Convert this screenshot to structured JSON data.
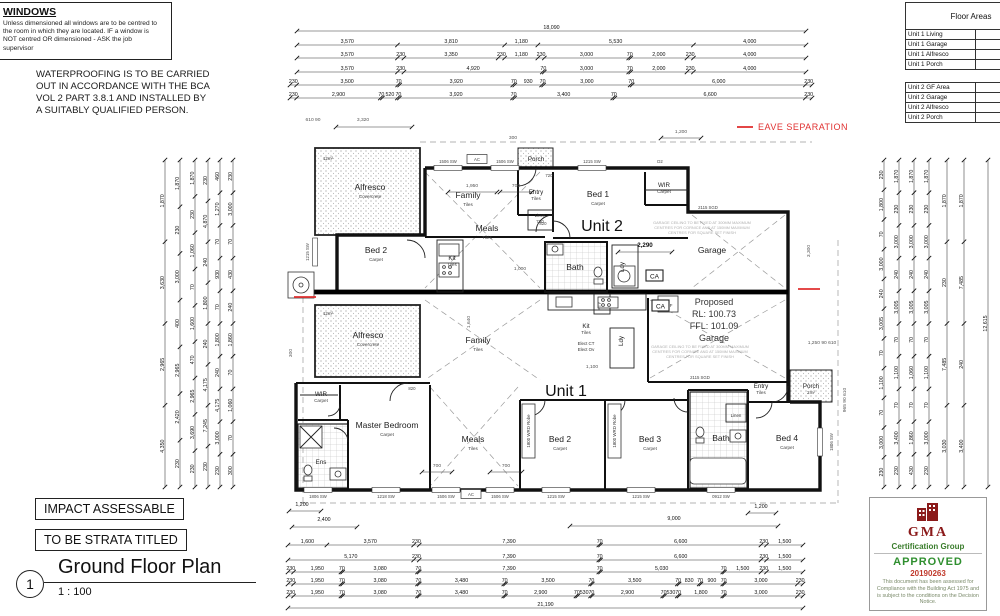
{
  "notes": {
    "windows_title": "WINDOWS",
    "windows_body": "Unless dimensioned all windows are to be centred to\nthe room in which they are located. IF a window is\nNOT centred OR dimensioned - ASK the job\nsupervisor",
    "waterproofing": "WATERPROOFING IS TO BE CARRIED\nOUT IN ACCORDANCE WITH THE BCA\nVOL 2 PART 3.8.1 AND INSTALLED BY\nA SUITABLY QUALIFIED PERSON."
  },
  "floor_areas": {
    "title": "Floor Areas",
    "unit1_rows": [
      "Unit 1 Living",
      "Unit 1 Garage",
      "Unit 1 Alfresco",
      "Unit 1 Porch"
    ],
    "unit2_rows": [
      "Unit 2 GF Area",
      "Unit 2 Garage",
      "Unit 2 Alfresco",
      "Unit 2 Porch"
    ]
  },
  "legend": {
    "eave_separation": "EAVE SEPARATION"
  },
  "stamps": {
    "impact": "IMPACT ASSESSABLE",
    "strata": "TO BE STRATA TITLED"
  },
  "title_block": {
    "number": "1",
    "title": "Ground Floor Plan",
    "scale": "1 : 100"
  },
  "approval": {
    "org": "GMA",
    "group": "Certification Group",
    "status": "APPROVED",
    "number": "20190263",
    "note": "This document has been assessed for Compliance with the Building Act 1975 and is subject to the conditions on the Decision Notice."
  },
  "plan": {
    "ca_label": "CA",
    "proposed_lines": [
      "Proposed",
      "RL:  100.73",
      "FFL: 101.09",
      "Garage"
    ],
    "garage_note_lines": [
      "GARAGE CEILING TO BE FIXED AT 300MM MAXIMUM",
      "CENTRES FOR CORNICE AND AT 150MM MAXIMUM",
      "CENTRES FOR SQUARE SET FINISH"
    ],
    "robe_label": "1800 WRD Robe",
    "rooms": [
      {
        "t": "Alfresco",
        "s": "Covercrete",
        "x": 370,
        "y": 190,
        "c": "room"
      },
      {
        "t": "12m²",
        "x": 328,
        "y": 160,
        "c": "tiny"
      },
      {
        "t": "Porch",
        "x": 536,
        "y": 161,
        "c": "small"
      },
      {
        "t": "Entry",
        "s": "Tiles",
        "x": 536,
        "y": 194,
        "c": "small"
      },
      {
        "t": "Family",
        "s": "Tiles",
        "x": 468,
        "y": 198,
        "c": "room"
      },
      {
        "t": "Meals",
        "s": "Tiles",
        "x": 487,
        "y": 231,
        "c": "room"
      },
      {
        "t": "Bed 1",
        "s": "Carpet",
        "x": 598,
        "y": 197,
        "c": "room"
      },
      {
        "t": "WIR",
        "s": "Carpet",
        "x": 664,
        "y": 187,
        "c": "small"
      },
      {
        "t": "Unit 2",
        "x": 602,
        "y": 231,
        "c": "unit"
      },
      {
        "t": "Bed 2",
        "s": "Carpet",
        "x": 376,
        "y": 253,
        "c": "room"
      },
      {
        "t": "Kit",
        "s": "Tiles",
        "x": 452,
        "y": 260,
        "c": "small"
      },
      {
        "t": "Bath",
        "x": 575,
        "y": 270,
        "c": "room"
      },
      {
        "t": "Ldy",
        "x": 624,
        "y": 267,
        "c": "small",
        "rot": true
      },
      {
        "t": "Linen",
        "s": "720",
        "x": 540,
        "y": 217,
        "c": "tiny"
      },
      {
        "t": "Garage",
        "x": 712,
        "y": 253,
        "c": "room"
      },
      {
        "t": "Alfresco",
        "s": "Covercrete",
        "x": 368,
        "y": 338,
        "c": "room"
      },
      {
        "t": "12m²",
        "x": 328,
        "y": 315,
        "c": "tiny"
      },
      {
        "t": "Family",
        "s": "Tiles",
        "x": 478,
        "y": 343,
        "c": "room"
      },
      {
        "t": "Kit",
        "s": "Tiles",
        "x": 586,
        "y": 328,
        "c": "small"
      },
      {
        "t": "Elect CT",
        "x": 586,
        "y": 345,
        "c": "tiny"
      },
      {
        "t": "Elect Ov",
        "x": 586,
        "y": 351,
        "c": "tiny"
      },
      {
        "t": "Ldy",
        "x": 623,
        "y": 341,
        "c": "small",
        "rot": true
      },
      {
        "t": "PTY",
        "x": 601,
        "y": 306,
        "c": "tiny",
        "rot": true
      },
      {
        "t": "REF",
        "x": 668,
        "y": 307,
        "c": "tiny"
      },
      {
        "t": "Unit 1",
        "x": 566,
        "y": 396,
        "c": "unit"
      },
      {
        "t": "WIR",
        "s": "Carpet",
        "x": 321,
        "y": 396,
        "c": "small"
      },
      {
        "t": "Master Bedroom",
        "s": "Carpet",
        "x": 387,
        "y": 428,
        "c": "room"
      },
      {
        "t": "Ens",
        "x": 321,
        "y": 464,
        "c": "small"
      },
      {
        "t": "Meals",
        "s": "Tiles",
        "x": 473,
        "y": 442,
        "c": "room"
      },
      {
        "t": "Bed 2",
        "s": "Carpet",
        "x": 560,
        "y": 442,
        "c": "room"
      },
      {
        "t": "Bed 3",
        "s": "Carpet",
        "x": 650,
        "y": 442,
        "c": "room"
      },
      {
        "t": "Bath",
        "x": 721,
        "y": 441,
        "c": "room"
      },
      {
        "t": "Bed 4",
        "s": "Carpet",
        "x": 787,
        "y": 441,
        "c": "room"
      },
      {
        "t": "Linen",
        "x": 736,
        "y": 417,
        "c": "tiny"
      },
      {
        "t": "Entry",
        "s": "Tiles",
        "x": 761,
        "y": 388,
        "c": "small"
      },
      {
        "t": "Porch",
        "s": "2m²",
        "x": 811,
        "y": 388,
        "c": "small"
      }
    ],
    "window_labels": [
      {
        "t": "1506 SW",
        "x": 448,
        "y": 163,
        "side": "top"
      },
      {
        "t": "AC",
        "x": 477,
        "y": 161,
        "box": true
      },
      {
        "t": "1506 SW",
        "x": 505,
        "y": 163,
        "side": "top"
      },
      {
        "t": "1215 SW",
        "x": 592,
        "y": 163,
        "side": "top"
      },
      {
        "t": "D2",
        "x": 660,
        "y": 163
      },
      {
        "t": "2115 SGD",
        "x": 708,
        "y": 209
      },
      {
        "t": "2115 SGD",
        "x": 700,
        "y": 379
      },
      {
        "t": "1215 SW",
        "x": 309,
        "y": 252,
        "rot": true,
        "side": "left"
      },
      {
        "t": "1806 SW",
        "x": 318,
        "y": 498,
        "side": "bottom"
      },
      {
        "t": "1218 SW",
        "x": 386,
        "y": 498,
        "side": "bottom"
      },
      {
        "t": "1506 SW",
        "x": 446,
        "y": 498,
        "side": "bottom"
      },
      {
        "t": "AC",
        "x": 471,
        "y": 496,
        "box": true
      },
      {
        "t": "1506 SW",
        "x": 500,
        "y": 498,
        "side": "bottom"
      },
      {
        "t": "1215 SW",
        "x": 556,
        "y": 498,
        "side": "bottom"
      },
      {
        "t": "1215 SW",
        "x": 641,
        "y": 498,
        "side": "bottom"
      },
      {
        "t": "0912 SW",
        "x": 721,
        "y": 498,
        "side": "bottom"
      },
      {
        "t": "1806 SW",
        "x": 833,
        "y": 442,
        "rot": true,
        "side": "right"
      },
      {
        "t": "720",
        "x": 549,
        "y": 177
      },
      {
        "t": "820",
        "x": 543,
        "y": 225
      },
      {
        "t": "820",
        "x": 412,
        "y": 390
      }
    ],
    "internal_dims": [
      {
        "t": "610 90",
        "x": 313,
        "y": 121
      },
      {
        "t": "3,320",
        "x": 363,
        "y": 121,
        "line": [
          336,
          127,
          412,
          127
        ]
      },
      {
        "t": "300",
        "x": 513,
        "y": 139
      },
      {
        "t": "1,200",
        "x": 681,
        "y": 133,
        "line": [
          661,
          138,
          701,
          138
        ]
      },
      {
        "t": "1,950",
        "x": 472,
        "y": 187,
        "line": [
          448,
          192,
          497,
          192
        ]
      },
      {
        "t": "700",
        "x": 516,
        "y": 187,
        "line": [
          500,
          192,
          532,
          192
        ]
      },
      {
        "t": "2,290",
        "x": 645,
        "y": 247,
        "b": true,
        "line": [
          618,
          252,
          672,
          252
        ]
      },
      {
        "t": "1,000",
        "x": 520,
        "y": 270
      },
      {
        "t": "1,640",
        "x": 470,
        "y": 322,
        "rot": true
      },
      {
        "t": "1,100",
        "x": 592,
        "y": 368
      },
      {
        "t": "700",
        "x": 437,
        "y": 467,
        "line": [
          422,
          472,
          452,
          472
        ]
      },
      {
        "t": "700",
        "x": 506,
        "y": 467,
        "line": [
          490,
          472,
          522,
          472
        ]
      },
      {
        "t": "300",
        "x": 292,
        "y": 353,
        "rot": true
      },
      {
        "t": "3,300",
        "x": 810,
        "y": 251,
        "rot": true
      },
      {
        "t": "1,250 90 610",
        "x": 822,
        "y": 344
      },
      {
        "t": "965 90 610",
        "x": 846,
        "y": 400,
        "rot": true
      }
    ]
  },
  "dimensions": {
    "top_rows": [
      [
        "18,090"
      ],
      [
        "3,570",
        "3,810",
        "1,180",
        "5,530",
        "4,000"
      ],
      [
        "3,570",
        "230",
        "3,350",
        "230",
        "1,180",
        "230",
        "3,000",
        "70",
        "2,000",
        "230",
        "4,000"
      ],
      [
        "3,570",
        "230",
        "4,920",
        "70",
        "3,000",
        "70",
        "2,000",
        "230",
        "4,000"
      ],
      [
        "230",
        "3,500",
        "70",
        "3,920",
        "70",
        "930",
        "70",
        "3,000",
        "70",
        "6,000",
        "230"
      ],
      [
        "230",
        "2,900",
        "70",
        "520",
        "70",
        "3,920",
        "70",
        "3,400",
        "70",
        "6,600",
        "230"
      ]
    ],
    "bottom_rows": [
      [
        "1,600",
        "3,570",
        "230",
        "7,390",
        "70",
        "6,600",
        "230",
        "1,500"
      ],
      [
        "5,170",
        "230",
        "7,390",
        "70",
        "6,600",
        "230",
        "1,500"
      ],
      [
        "230",
        "1,950",
        "70",
        "3,080",
        "70",
        "7,390",
        "70",
        "5,030",
        "70",
        "1,500",
        "230",
        "1,500"
      ],
      [
        "230",
        "1,950",
        "70",
        "3,080",
        "70",
        "3,480",
        "70",
        "3,500",
        "70",
        "3,500",
        "70",
        "830",
        "70",
        "900",
        "70",
        "3,000",
        "230"
      ],
      [
        "230",
        "1,950",
        "70",
        "3,080",
        "70",
        "3,480",
        "70",
        "2,900",
        "70",
        "530",
        "70",
        "2,900",
        "70",
        "530",
        "70",
        "1,800",
        "70",
        "3,000",
        "230"
      ],
      [
        "21,190"
      ]
    ],
    "extra_dims": [
      {
        "t": "1,200",
        "x": 302,
        "y": 506,
        "line": [
          289,
          511,
          321,
          511
        ]
      },
      {
        "t": "2,400",
        "x": 324,
        "y": 521,
        "line": [
          292,
          527,
          357,
          527
        ]
      },
      {
        "t": "9,000",
        "x": 674,
        "y": 520,
        "line": [
          570,
          526,
          778,
          526
        ]
      },
      {
        "t": "1,200",
        "x": 761,
        "y": 508,
        "line": [
          748,
          513,
          776,
          513
        ]
      }
    ],
    "left_cols": [
      [
        "1,870",
        "3,630",
        "2,965",
        "4,350"
      ],
      [
        "1,870",
        "230",
        "3,000",
        "400",
        "2,965",
        "2,420",
        "230"
      ],
      [
        "1,870",
        "230",
        "1,060",
        "70",
        "1,600",
        "470",
        "2,965",
        "3,690",
        "230"
      ],
      [
        "230",
        "4,870",
        "240",
        "1,800",
        "240",
        "4,175",
        "7,245",
        "230"
      ],
      [
        "460",
        "1,270",
        "70",
        "930",
        "70",
        "1,800",
        "240",
        "4,175",
        "3,000",
        "230"
      ],
      [
        "230",
        "3,000",
        "70",
        "430",
        "240",
        "1,860",
        "70",
        "1,060",
        "70",
        "300"
      ]
    ],
    "right_cols": [
      [
        "230",
        "1,800",
        "70",
        "3,000",
        "240",
        "3,005",
        "70",
        "1,100",
        "70",
        "3,000",
        "230"
      ],
      [
        "1,870",
        "230",
        "3,000",
        "240",
        "3,005",
        "70",
        "1,100",
        "70",
        "3,400",
        "230"
      ],
      [
        "1,870",
        "230",
        "3,000",
        "240",
        "3,005",
        "70",
        "1,060",
        "70",
        "1,860",
        "430"
      ],
      [
        "1,870",
        "230",
        "3,000",
        "240",
        "3,005",
        "70",
        "1,100",
        "70",
        "3,000",
        "230"
      ],
      [
        "1,870",
        "230",
        "7,485",
        "3,030"
      ],
      [
        "1,870",
        "7,485",
        "240",
        "3,400"
      ],
      [
        "12,615"
      ]
    ]
  }
}
